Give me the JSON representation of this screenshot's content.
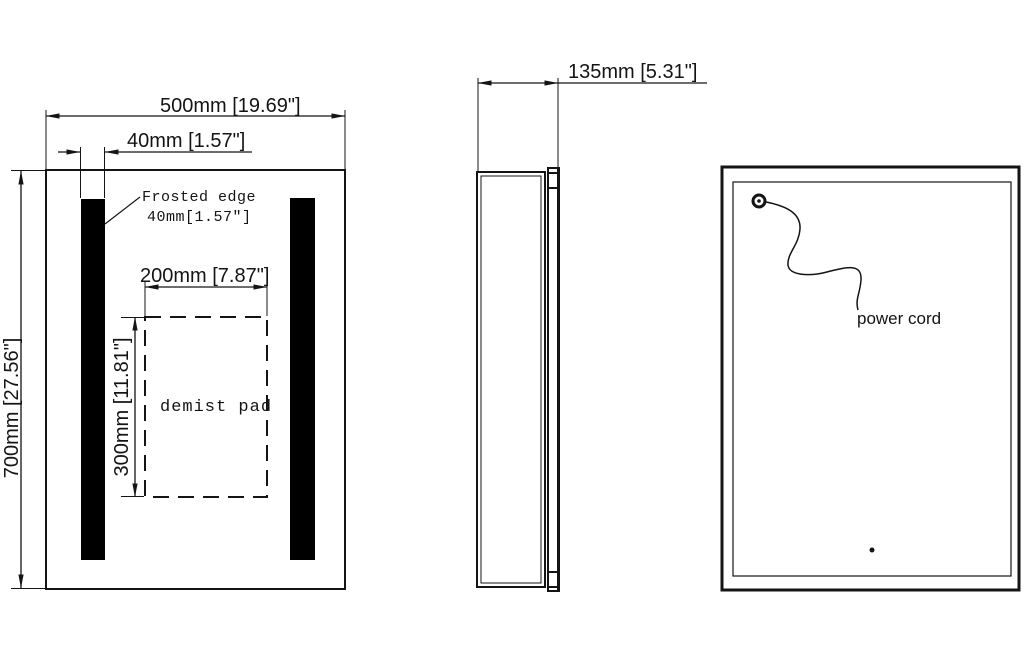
{
  "drawing": {
    "front_view": {
      "width_dim": "500mm [19.69\"]",
      "strip_width_dim": "40mm [1.57\"]",
      "height_dim": "700mm [27.56\"]",
      "frosted_edge_line1": "Frosted edge",
      "frosted_edge_line2": "40mm[1.57″]",
      "demist_width_dim": "200mm [7.87\"]",
      "demist_height_dim": "300mm [11.81\"]",
      "demist_label": "demist pad"
    },
    "side_view": {
      "depth_dim": "135mm [5.31\"]"
    },
    "back_view": {
      "power_cord_label": "power cord"
    },
    "colors": {
      "line": "#141414",
      "strip_fill": "#000000",
      "background": "#ffffff"
    }
  }
}
